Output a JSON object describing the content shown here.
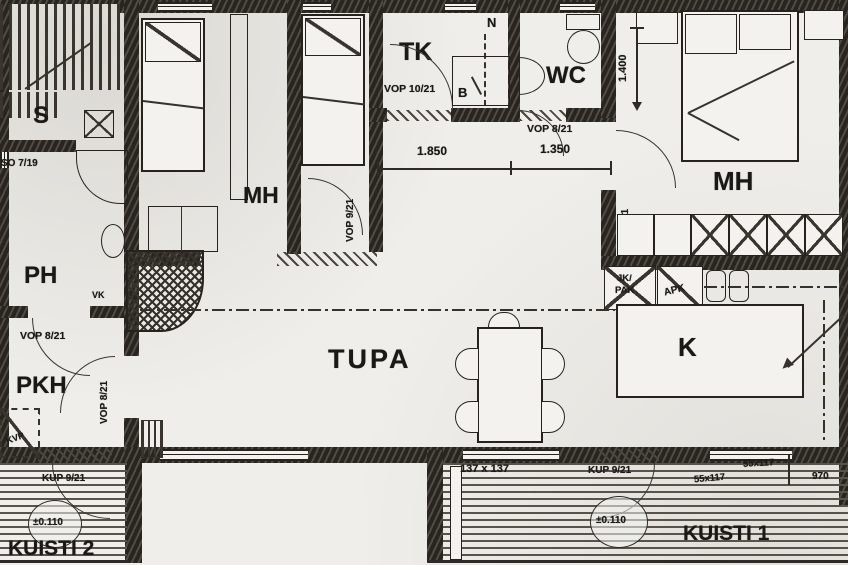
{
  "drawing": {
    "type": "scanned cottage floor plan",
    "paper_color": "#efeeea",
    "ink_color": "#26231e"
  },
  "rooms": {
    "sauna": "S",
    "washroom": "PH",
    "dressing_room": "PKH",
    "bedroom": "MH",
    "utility_room": "TK",
    "toilet": "WC",
    "living_room": "TUPA",
    "kitchen": "K",
    "porch_1": "KUISTI 1",
    "porch_2": "KUISTI 2"
  },
  "door_marks": {
    "vop_8_21": "VOP 8/21",
    "vop_9_21": "VOP 9/21",
    "vop_10_21": "VOP 10/21",
    "kup_9_21": "KUP 9/21",
    "so_7_19": "SO 7/19"
  },
  "dimensions": {
    "d_1850": "1.850",
    "d_1350": "1.350",
    "d_1400": "1.400",
    "d_137x137": "137 x 137",
    "d_55x117": "55x117",
    "d_970": "970",
    "floor_level": "±0.110"
  },
  "fixtures": {
    "niche": "N",
    "boiler": "B",
    "floor_drain": "VK",
    "water_point": "KVP",
    "fridge_line1": "JK/",
    "fridge_line2": "PAK",
    "dishwasher": "APK"
  }
}
